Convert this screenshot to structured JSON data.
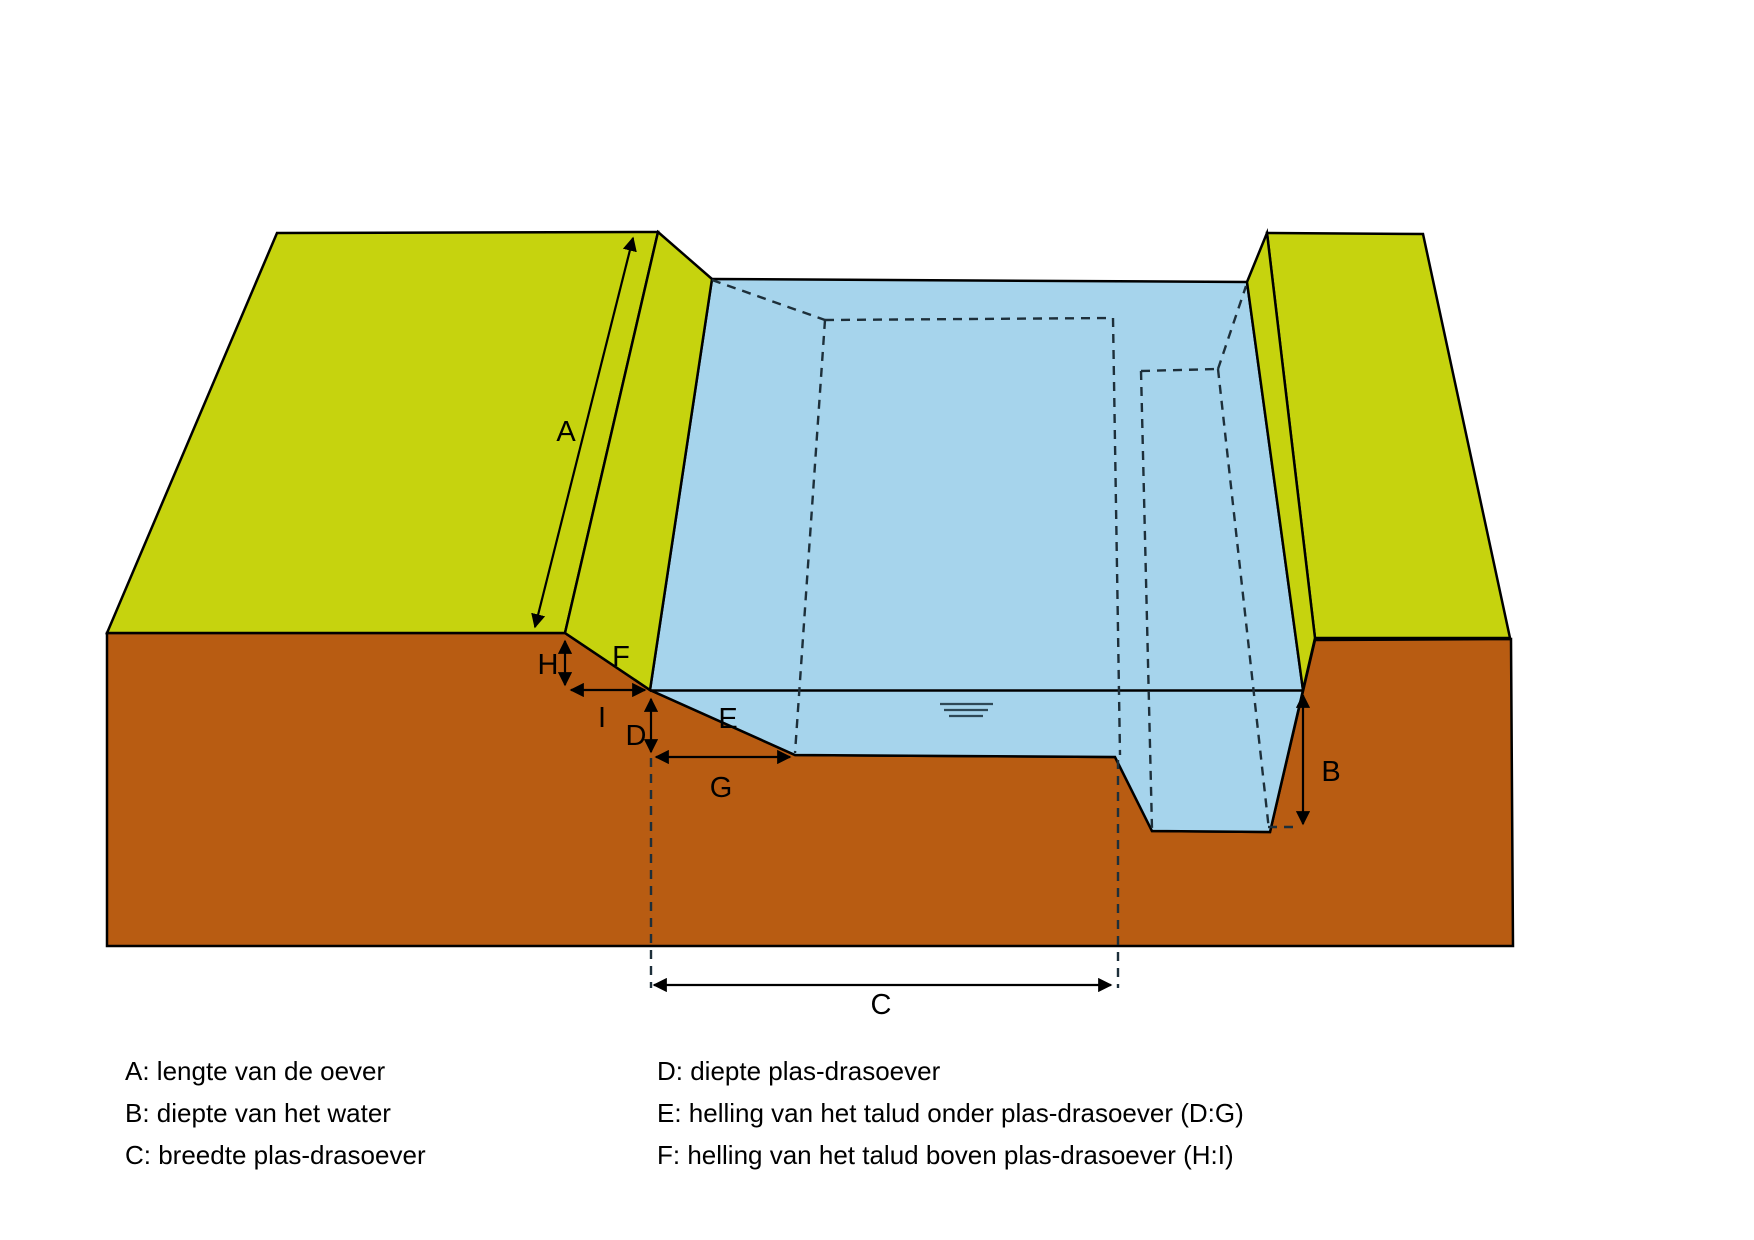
{
  "diagram": {
    "labels": {
      "A": "A",
      "B": "B",
      "C": "C",
      "D": "D",
      "E": "E",
      "F": "F",
      "G": "G",
      "H": "H",
      "I": "I"
    }
  },
  "legend": {
    "left": [
      "A: lengte van de oever",
      "B: diepte van het water",
      "C: breedte plas-drasoever"
    ],
    "right": [
      "D: diepte plas-drasoever",
      "E: helling van het talud onder plas-drasoever (D:G)",
      "F: helling van het talud boven plas-drasoever (H:I)"
    ]
  },
  "colors": {
    "grass": "#c6d30e",
    "soil": "#b85c12",
    "water": "#a6d4ec",
    "outline": "#000000",
    "dashes": "#1d2f3a",
    "ripple": "#2e4856"
  },
  "icons": {
    "water_level": "water-level-ripple"
  }
}
